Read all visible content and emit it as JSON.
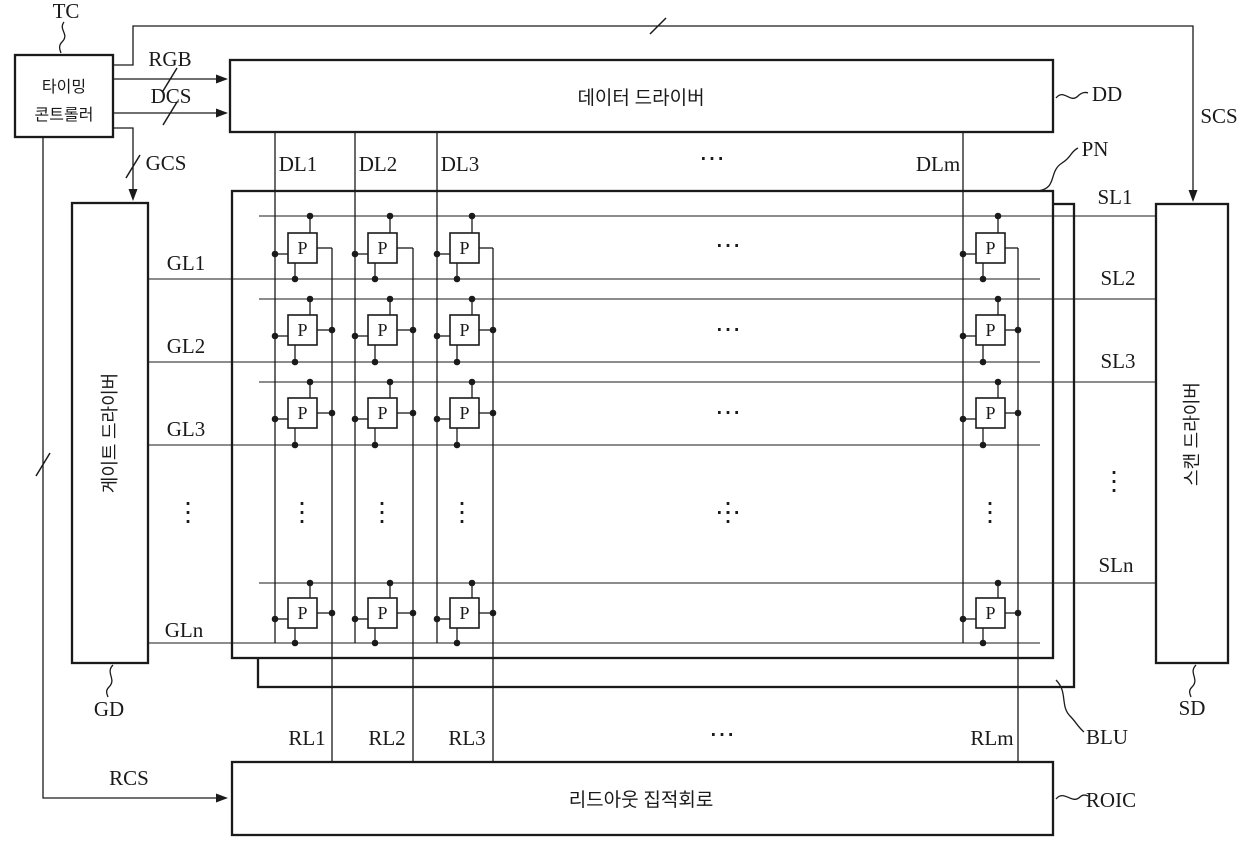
{
  "figure": {
    "timing_controller": {
      "label": "TC",
      "line1": "타이밍",
      "line2": "콘트롤러"
    },
    "data_driver": {
      "label": "DD",
      "title": "데이터 드라이버"
    },
    "gate_driver": {
      "label": "GD",
      "title": "게이트 드라이버"
    },
    "scan_driver": {
      "label": "SD",
      "title": "스캔 드라이버"
    },
    "readout_ic": {
      "label": "ROIC",
      "title": "리드아웃 집적회로"
    },
    "panel": {
      "label": "PN",
      "pixel_label": "P"
    },
    "backlight": {
      "label": "BLU"
    },
    "signals": {
      "rgb": "RGB",
      "dcs": "DCS",
      "gcs": "GCS",
      "scs": "SCS",
      "rcs": "RCS"
    },
    "data_lines": [
      "DL1",
      "DL2",
      "DL3",
      "DLm"
    ],
    "gate_lines": [
      "GL1",
      "GL2",
      "GL3",
      "GLn"
    ],
    "scan_lines": [
      "SL1",
      "SL2",
      "SL3",
      "SLn"
    ],
    "readout_lines": [
      "RL1",
      "RL2",
      "RL3",
      "RLm"
    ],
    "ellipsis_h": "⋯",
    "ellipsis_v": "⋮",
    "colors": {
      "ink": "#1a1a1a",
      "paper": "#ffffff"
    }
  }
}
